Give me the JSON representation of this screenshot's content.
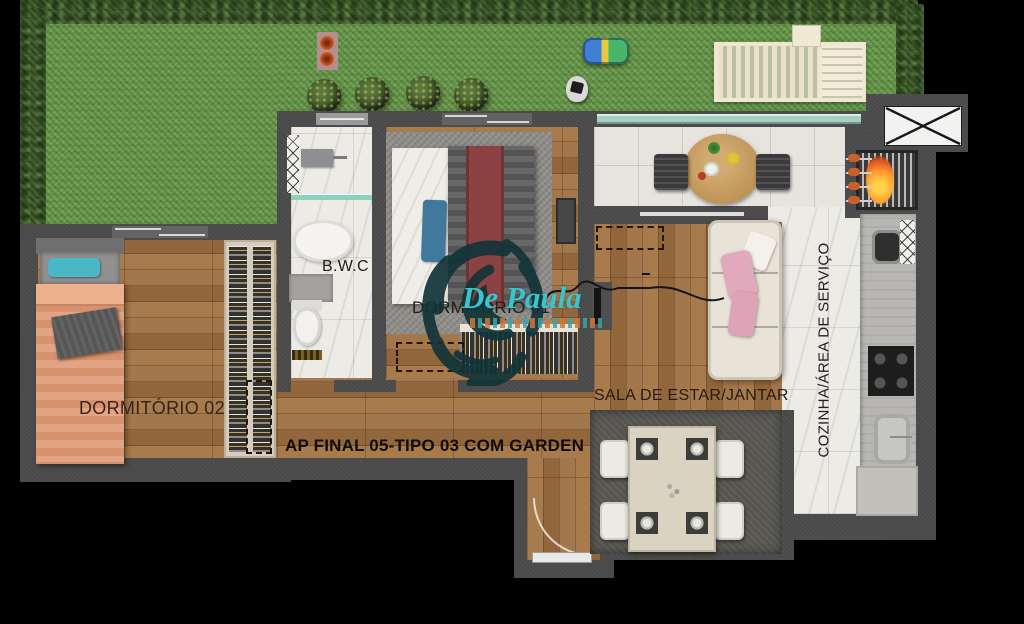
{
  "title": {
    "text": "AP FINAL 05-TIPO 03 COM GARDEN"
  },
  "rooms": {
    "dormitorio2": "DORMITÓRIO 02",
    "bwc": "B.W.C",
    "dormitorio1": "DORMITÓRIO 01",
    "sala": "SALA DE ESTAR/JANTAR",
    "cozinha": "COZINHA/ÁREA DE SERVIÇO"
  },
  "watermark": {
    "brand": "De Paula"
  },
  "colors": {
    "grass": "#6b9a4f",
    "hedge": "#405c2c",
    "wall": "#494949",
    "wood": "#9d7043",
    "marble": "#edebe6",
    "glass": "#a9cfc2",
    "brand_teal": "#3cc4cc",
    "blanket_orange": "#e09a78",
    "pillow_teal": "#49b7c6",
    "runner_maroon": "#8c4242",
    "pillow_pink": "#e2a9bd"
  }
}
